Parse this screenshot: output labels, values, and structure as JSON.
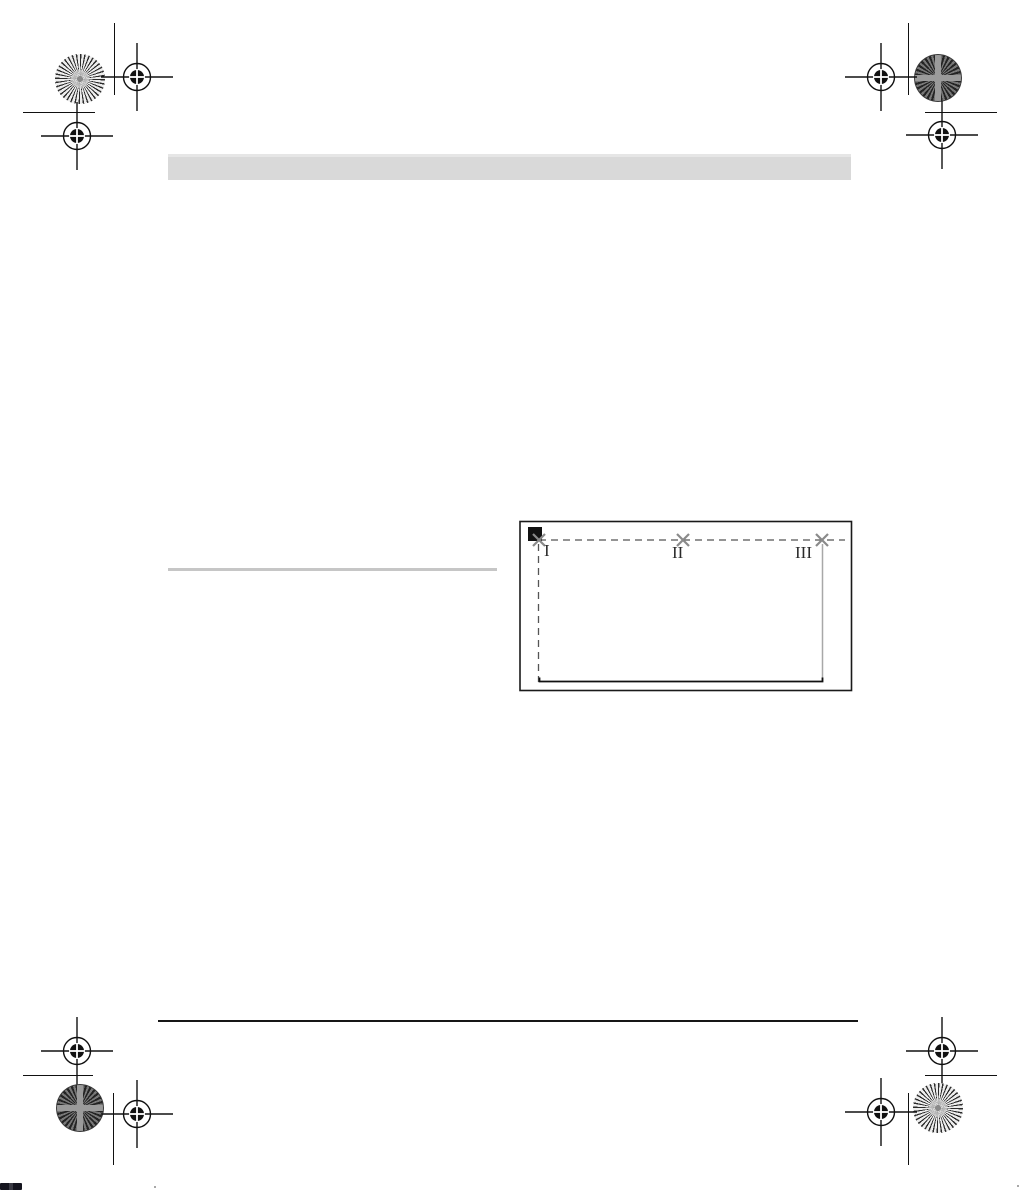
{
  "colors": {
    "page_bg": "#ffffff",
    "header_bar": "#d9d9d9",
    "header_bar_top": "#e6e6e6",
    "section_rule": "#c6c6c6",
    "footer_rule": "#161616",
    "figure_border": "#1a1a1a",
    "dash_line": "#555555",
    "x_mark": "#8a8a8a",
    "vertical_solid": "#a8a8a8",
    "mark_ink": "#111111"
  },
  "figure": {
    "markers": [
      {
        "label": "I"
      },
      {
        "label": "II"
      },
      {
        "label": "III"
      }
    ]
  }
}
